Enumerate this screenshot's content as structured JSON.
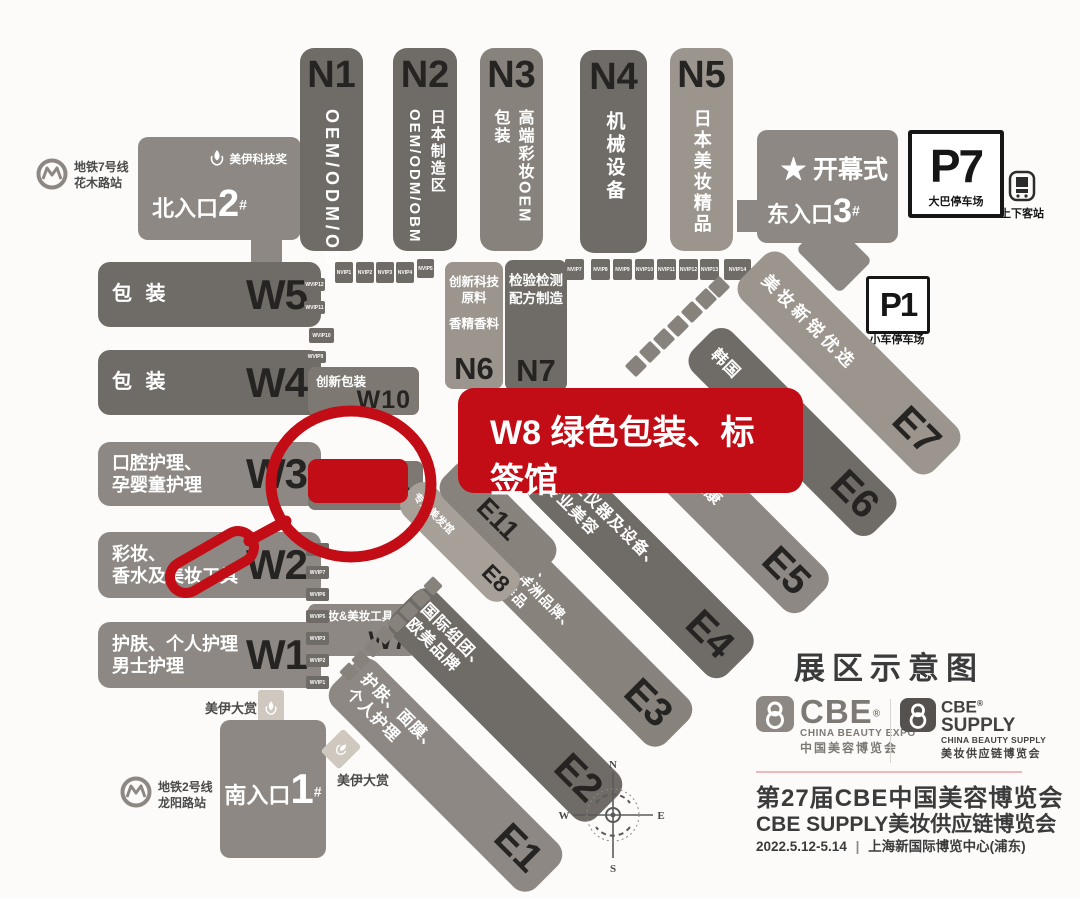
{
  "highlight": {
    "banner_text": "W8 绿色包装、标签馆",
    "color": "#c30d16"
  },
  "n_halls": [
    {
      "code": "N1",
      "cols": [
        "OEM/ODM/OBM"
      ]
    },
    {
      "code": "N2",
      "cols": [
        "日本制造区",
        "OEM/ODM/OBM"
      ]
    },
    {
      "code": "N3",
      "cols": [
        "高端彩妆OEM",
        "包装"
      ]
    },
    {
      "code": "N4",
      "cols": [
        "机械设备"
      ]
    },
    {
      "code": "N5",
      "cols": [
        "日本美妆精品"
      ]
    }
  ],
  "n_small": [
    {
      "code": "N6",
      "label1": "创新科技原料",
      "label2": "香精香料"
    },
    {
      "code": "N7",
      "label1": "检验检测",
      "label2": "配方制造"
    }
  ],
  "w_halls": [
    {
      "code": "W5",
      "lines": [
        "包 装",
        ""
      ]
    },
    {
      "code": "W4",
      "lines": [
        "包 装",
        ""
      ]
    },
    {
      "code": "W3",
      "lines": [
        "口腔护理、",
        "孕婴童护理"
      ]
    },
    {
      "code": "W2",
      "lines": [
        "彩妆、",
        "香水及美妆工具"
      ]
    },
    {
      "code": "W1",
      "lines": [
        "护肤、个人护理",
        "男士护理"
      ]
    }
  ],
  "w_annex": [
    {
      "code": "W10",
      "label": "创新包装"
    },
    {
      "code": "W9",
      "label": "创新包装、纸盒袋"
    },
    {
      "code": "W7",
      "label": "彩妆&美妆工具"
    }
  ],
  "e_halls": [
    {
      "code": "E7",
      "lines": [
        "美妆新锐优选",
        "",
        ""
      ]
    },
    {
      "code": "E6",
      "lines": [
        "韩国",
        "",
        ""
      ]
    },
    {
      "code": "E5",
      "lines": [
        "大健康",
        "",
        ""
      ]
    },
    {
      "code": "E4",
      "lines": [
        "专业仪器及设备、",
        "专业美容",
        ""
      ]
    },
    {
      "code": "E3",
      "lines": [
        "国际组团、",
        "亚洲/大洋洲品牌、",
        "口服保养品"
      ]
    },
    {
      "code": "E2",
      "lines": [
        "国际组团、",
        "欧美品牌",
        ""
      ]
    },
    {
      "code": "E1",
      "lines": [
        "护肤、面膜、",
        "个人护理",
        ""
      ]
    },
    {
      "code": "E8",
      "lines": [
        "专业美发馆",
        "",
        ""
      ]
    },
    {
      "code": "E11",
      "lines": [
        "",
        "",
        ""
      ]
    }
  ],
  "entrances": {
    "north": {
      "name": "北入口",
      "number": "2",
      "hash": "#"
    },
    "south": {
      "name": "南入口",
      "number": "1",
      "hash": "#"
    },
    "east": {
      "name": "东入口",
      "number": "3",
      "hash": "#",
      "star": "★",
      "event": "开幕式"
    }
  },
  "parking": {
    "p7": {
      "code": "P7",
      "label": "大巴停车场"
    },
    "p1": {
      "code": "P1",
      "label": "小车停车场"
    }
  },
  "transit": {
    "metro7": {
      "line": "地铁7号线",
      "station": "花木路站"
    },
    "metro2": {
      "line": "地铁2号线",
      "station": "龙阳路站"
    },
    "bus_stop": "上下客站"
  },
  "awards": {
    "tech": "美伊科技奖",
    "grand_north": "美伊大赏",
    "grand_south": "美伊大赏"
  },
  "vip": {
    "nvip_row1": [
      "NVIP1",
      "NVIP2",
      "NVIP3",
      "NVIP4",
      "NVIP5"
    ],
    "nvip_row2": [
      "NVIP7",
      "NVIP8",
      "NVIP9",
      "NVIP10",
      "NVIP11",
      "NVIP12",
      "NVIP13",
      "NVIP14"
    ],
    "wvip_upper": [
      "WVIP12",
      "WVIP11",
      "WVIP10",
      "WVIP9"
    ],
    "wvip_lower": [
      "WVIP8",
      "WVIP7",
      "WVIP6",
      "WVIP5",
      "WVIP3",
      "WVIP2",
      "WVIP1"
    ]
  },
  "compass": {
    "n": "N",
    "e": "E",
    "s": "S",
    "w": "W"
  },
  "footer": {
    "title": "展区示意图",
    "cbe": {
      "name": "CBE",
      "reg": "®",
      "sub": "CHINA BEAUTY EXPO",
      "cn": "中国美容博览会"
    },
    "supply": {
      "name1": "CBE",
      "name2": "SUPPLY",
      "reg": "®",
      "sub": "CHINA BEAUTY SUPPLY",
      "cn": "美妆供应链博览会"
    },
    "line1": "第27届CBE中国美容博览会",
    "line2": "CBE SUPPLY美妆供应链博览会",
    "date": "2022.5.12-5.14",
    "sep": "|",
    "venue": "上海新国际博览中心(浦东)"
  }
}
